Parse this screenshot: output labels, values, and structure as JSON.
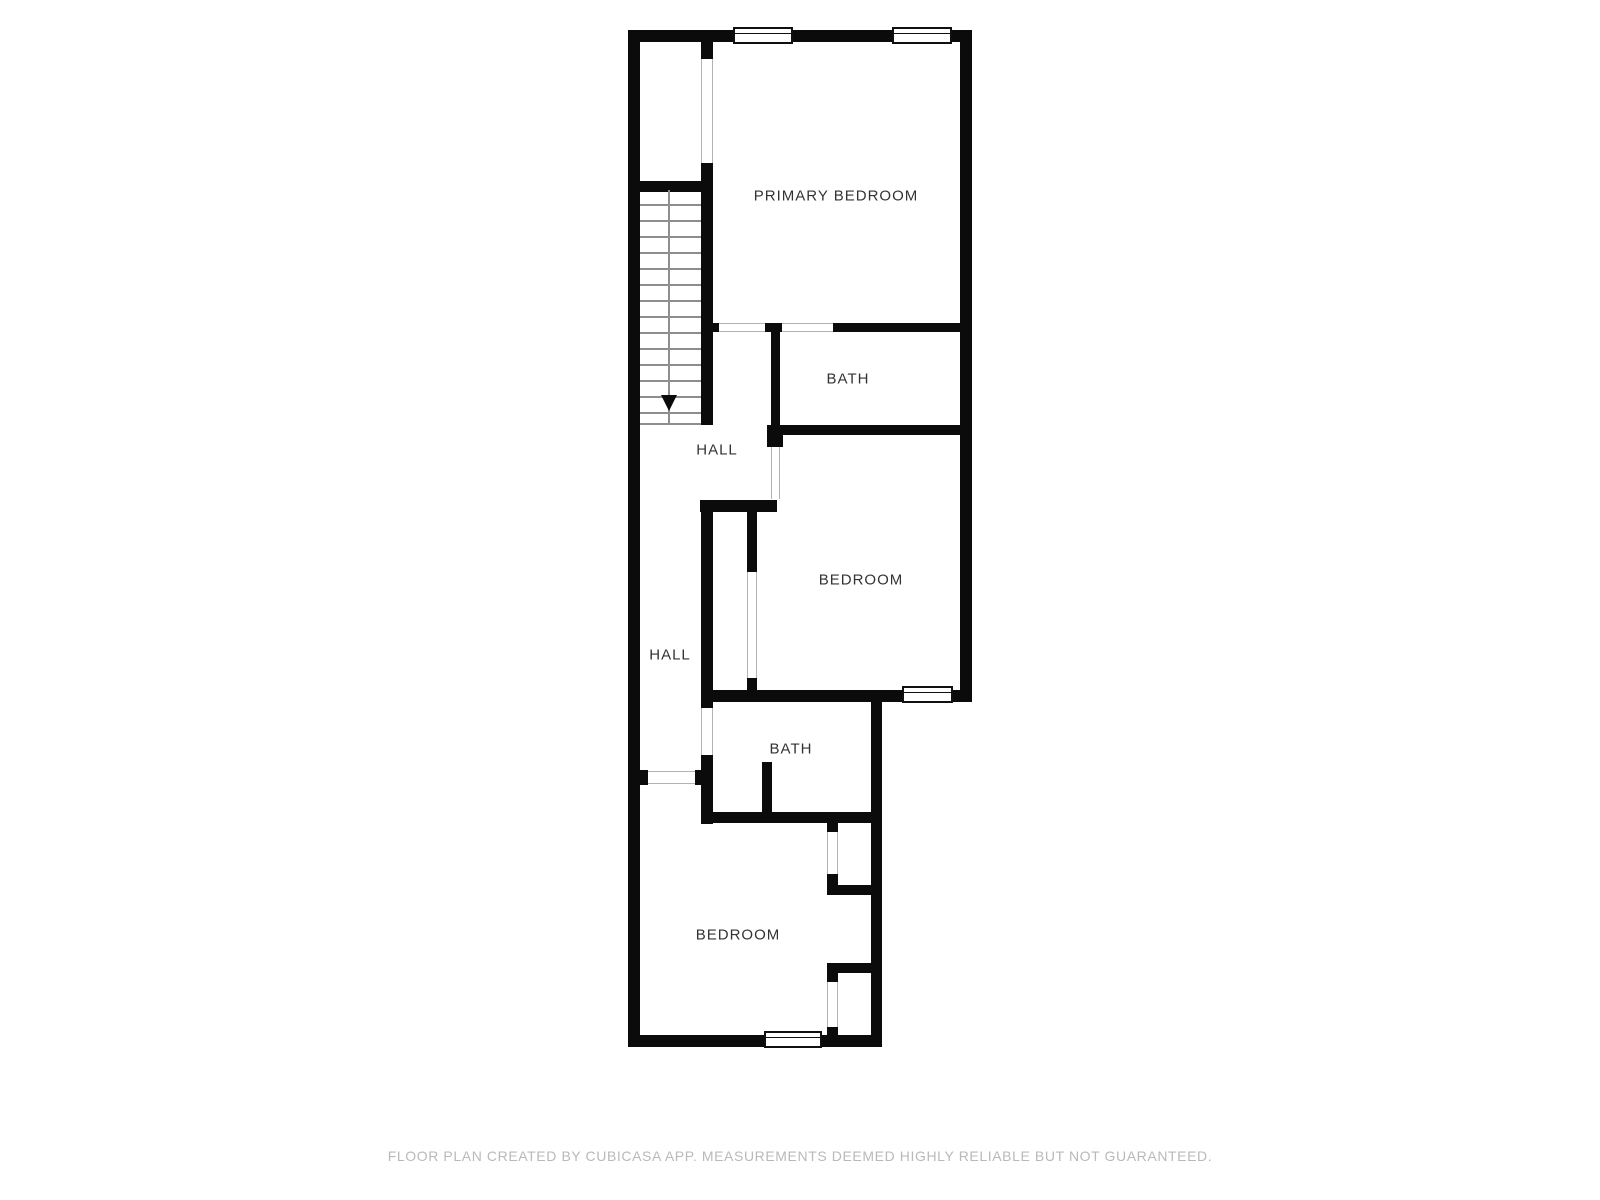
{
  "floor_plan": {
    "rooms": [
      {
        "name": "primary-bedroom",
        "label": "PRIMARY BEDROOM"
      },
      {
        "name": "bath-upper",
        "label": "BATH"
      },
      {
        "name": "hall-upper",
        "label": "HALL"
      },
      {
        "name": "bedroom-middle",
        "label": "BEDROOM"
      },
      {
        "name": "hall-lower",
        "label": "HALL"
      },
      {
        "name": "bath-lower",
        "label": "BATH"
      },
      {
        "name": "bedroom-lower",
        "label": "BEDROOM"
      }
    ],
    "stairs": {
      "tread_count": 14,
      "direction": "down"
    },
    "window_count": 4,
    "footer": "FLOOR PLAN CREATED BY CUBICASA APP. MEASUREMENTS DEEMED HIGHLY RELIABLE BUT NOT GUARANTEED.",
    "colors": {
      "wall": "#0b0b0b",
      "room_label": "#333333",
      "footer_text": "#b9b9b9",
      "opening_line": "#b3b3b3",
      "tread_line": "#8e8e8e"
    }
  }
}
